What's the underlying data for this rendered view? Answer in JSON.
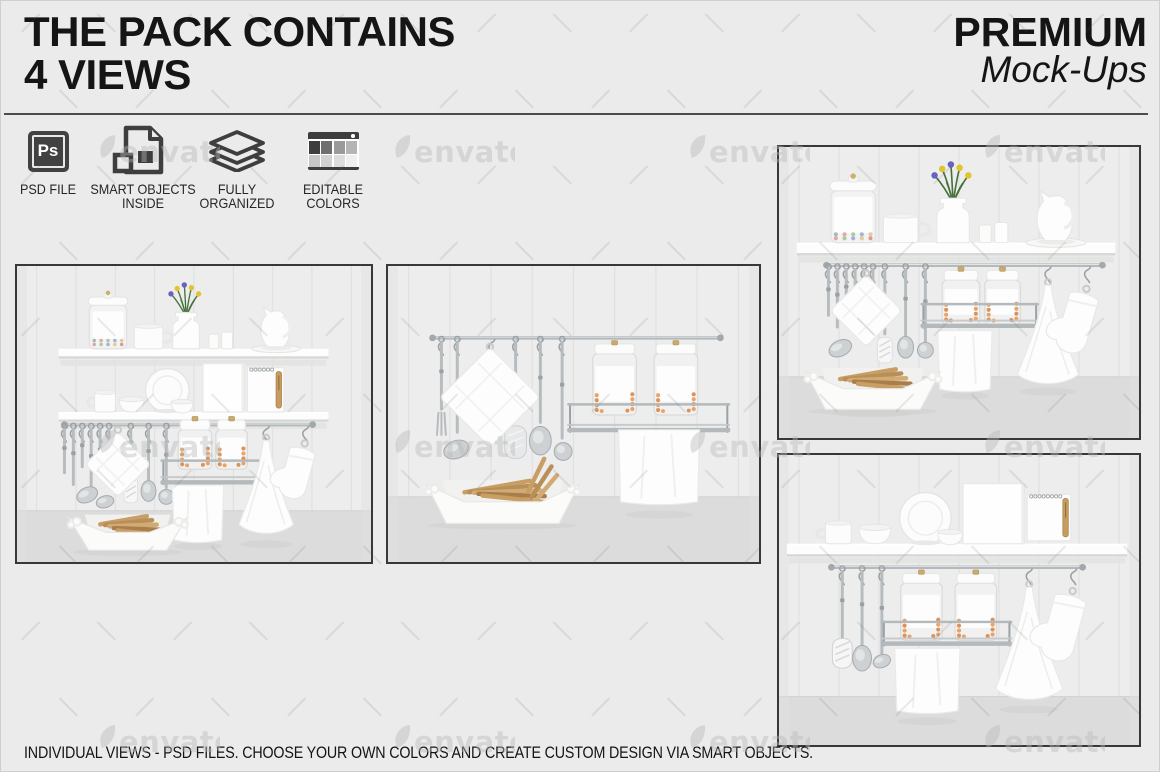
{
  "header": {
    "title_line1": "THE PACK CONTAINS",
    "title_line2": "4 VIEWS",
    "brand_line1": "PREMIUM",
    "brand_line2": "Mock-Ups"
  },
  "features": [
    {
      "icon": "photoshop-file-icon",
      "line1": "PSD FILE",
      "line2": ""
    },
    {
      "icon": "smart-objects-icon",
      "line1": "SMART OBJECTS",
      "line2": "INSIDE"
    },
    {
      "icon": "layers-stack-icon",
      "line1": "FULLY",
      "line2": "ORGANIZED"
    },
    {
      "icon": "color-swatches-icon",
      "line1": "EDITABLE",
      "line2": "COLORS"
    }
  ],
  "psd_icon_text": "Ps",
  "palette_swatches": {
    "top_row": [
      "#3d3d3d",
      "#6f6f6f",
      "#9a9a9a",
      "#b5b5b5"
    ],
    "bottom_row": [
      "#c6c6c6",
      "#d2d2d2",
      "#dcdcdc",
      "#efefef"
    ]
  },
  "gallery": [
    {
      "name": "mockup-view-1",
      "description": "Kitchen shelves with canister, mug, vase of flowers, cups, pitcher, plates, bowls, blank card, notepad, hanging rail with utensils, jars, towels, oven mitt and bread basket - full front view"
    },
    {
      "name": "mockup-view-2",
      "description": "Close-up of hanging rail with pot holder, utensils, jar rack with two jars, towel and bread basket"
    },
    {
      "name": "mockup-view-3",
      "description": "Single shelf with canister, mug, vase of flowers, cups and pitcher above hanging rail with utensils, jars, towels and oven mitt, bread basket below"
    },
    {
      "name": "mockup-view-4",
      "description": "Shelf with cup, bowls, plate, blank card and spiral notepad above hanging rail with utensils, jar rack, towel, cone towel and oven mitt"
    }
  ],
  "watermark": {
    "text": "envato",
    "color": "#b9b9b9",
    "row_centers_y": [
      152,
      447,
      742
    ],
    "col_centers_x": [
      158,
      453,
      748,
      1043
    ]
  },
  "footer": {
    "caption": "INDIVIDUAL VIEWS - PSD FILES. CHOOSE YOUR OWN COLORS AND CREATE CUSTOM DESIGN VIA SMART OBJECTS."
  },
  "colors": {
    "page_background": "#ebebeb",
    "text": "#151515",
    "icon_dark": "#3e3e3e",
    "frame_border": "#383838",
    "scene_wall": "#ecedec",
    "scene_floor": "#dbdcdb",
    "metal": "#b4b9bc",
    "bread_tan": "#c89e65",
    "jar_content_orange": "#e8a36b"
  }
}
